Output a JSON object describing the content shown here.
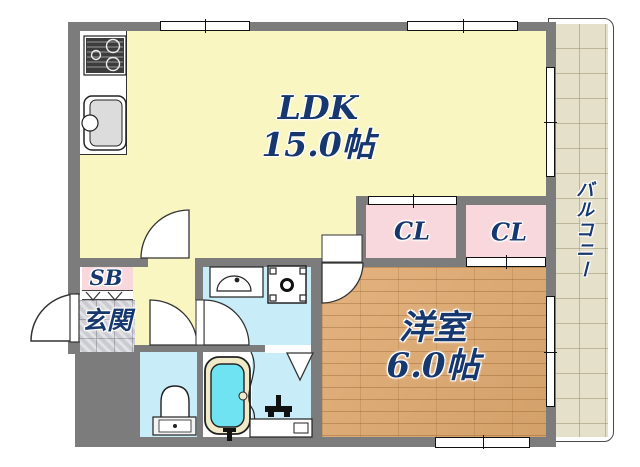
{
  "plan": {
    "rooms": {
      "ldk": {
        "name": "LDK",
        "size": "15.0帖"
      },
      "western_room": {
        "name": "洋室",
        "size": "6.0帖"
      },
      "closet_left": {
        "label": "CL"
      },
      "closet_right": {
        "label": "CL"
      },
      "shoe_box": {
        "label": "SB"
      },
      "entrance": {
        "label": "玄関"
      },
      "balcony": {
        "label": "バルコニー"
      }
    },
    "colors": {
      "ldk_fill": "#FAF6C1",
      "closet_fill": "#F8D8DC",
      "wet_area_fill": "#C8EDF8",
      "wood_fill": "#E0AA70",
      "balcony_fill": "#E5E0CA",
      "genkan_fill": "#CBCBD2",
      "wall": "#7C7C7C",
      "label_text": "#16386E",
      "bath_water": "#6FE3F2"
    }
  }
}
